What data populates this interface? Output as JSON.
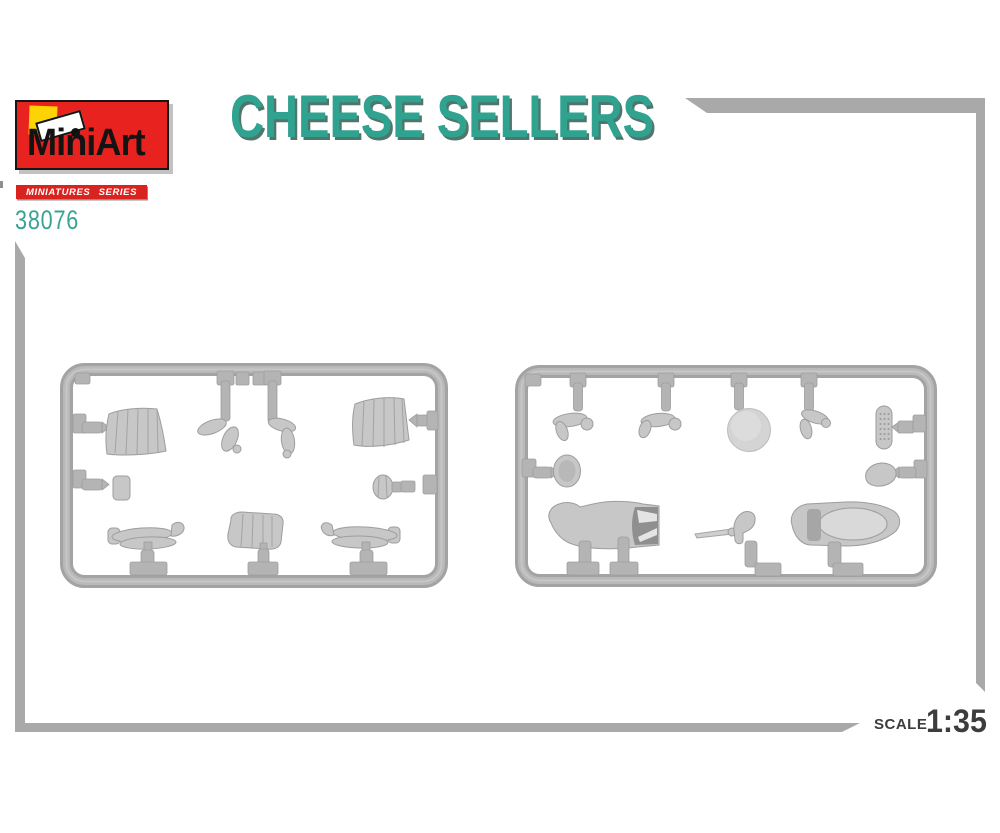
{
  "page": {
    "background": "#ffffff"
  },
  "header": {
    "logo": {
      "brand_name": "MiniArt",
      "bg_color": "#e8231f",
      "square_icon_color": "#fdd304",
      "flag_icon": "flag-icon"
    },
    "series_badge": {
      "label": "MINIATURES SERIES",
      "bg_color": "#d8231f",
      "text_color": "#ffffff"
    },
    "product_code": {
      "value": "38076",
      "color": "#3aa295"
    },
    "title": {
      "text": "CHEESE SELLERS",
      "color": "#2fa38f",
      "shadow_color": "#50756d"
    }
  },
  "frame_bars": {
    "color": "#a9a9a9"
  },
  "photo": {
    "description": "two grey injection-moulded plastic sprues with 1/35 scale figure parts",
    "sprue_color": "#b0b0b0",
    "sprue_a_parts": [
      "pleated skirt",
      "bent arm",
      "bent arm",
      "pleated skirt",
      "small block",
      "jug",
      "legs",
      "bodice",
      "legs"
    ],
    "sprue_b_parts": [
      "arm",
      "arm",
      "cheese wheel",
      "arm with hand",
      "grater",
      "round plate",
      "cheese piece",
      "coat",
      "knife with handle",
      "dress torso"
    ]
  },
  "footer": {
    "scale_label": "SCALE",
    "scale_value": "1:35",
    "color": "#3d3d3d"
  }
}
